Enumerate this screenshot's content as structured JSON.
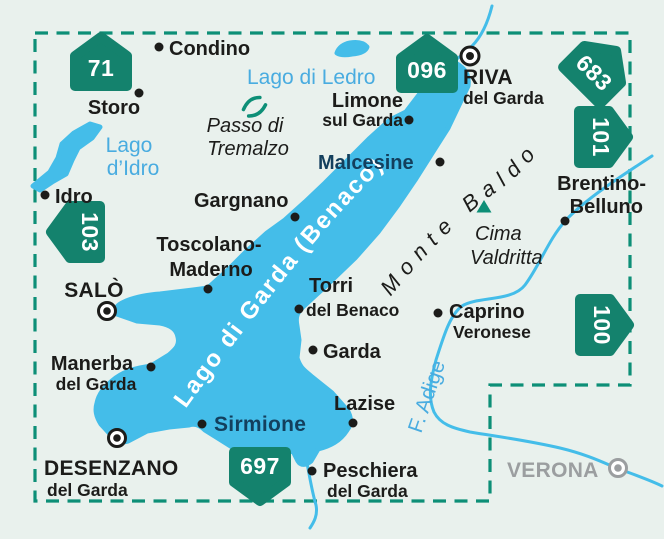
{
  "colors": {
    "background": "#e9f1ed",
    "water": "#44bde9",
    "water_label": "#49ace0",
    "badge_green": "#14826d",
    "boundary_teal": "#0d8f77",
    "town_black": "#1c1c1a",
    "lakeside_navy": "#133f5d",
    "outside_gray": "#9b9ea0",
    "label_white": "#ffffff"
  },
  "badges": {
    "b71": "71",
    "b096": "096",
    "b683": "683",
    "b101": "101",
    "b103": "103",
    "b100": "100",
    "b697": "697"
  },
  "places": {
    "condino": {
      "name": "Condino"
    },
    "storo": {
      "name": "Storo"
    },
    "idro": {
      "name": "Idro"
    },
    "riva": {
      "line1": "RIVA",
      "line2": "del Garda"
    },
    "limone": {
      "line1": "Limone",
      "line2": "sul Garda"
    },
    "malcesine": {
      "name": "Malcesine"
    },
    "gargnano": {
      "name": "Gargnano"
    },
    "toscolano": {
      "line1": "Toscolano-",
      "line2": "Maderno"
    },
    "brentino": {
      "line1": "Brentino-",
      "line2": "Belluno"
    },
    "salo": {
      "name": "SALÒ"
    },
    "manerba": {
      "line1": "Manerba",
      "line2": "del Garda"
    },
    "torri": {
      "line1": "Torri",
      "line2": "del Benaco"
    },
    "garda": {
      "name": "Garda"
    },
    "caprino": {
      "line1": "Caprino",
      "line2": "Veronese"
    },
    "sirmione": {
      "name": "Sirmione"
    },
    "lazise": {
      "name": "Lazise"
    },
    "desenzano": {
      "line1": "DESENZANO",
      "line2": "del Garda"
    },
    "peschiera": {
      "line1": "Peschiera",
      "line2": "del Garda"
    },
    "verona": {
      "name": "VERONA"
    }
  },
  "water_labels": {
    "lago_di_ledro": "Lago di Ledro",
    "lago_didro_1": "Lago",
    "lago_didro_2": "d’Idro",
    "adige": "F. Adige",
    "lake_garda": "Lago di Garda  (Benaco)"
  },
  "terrain": {
    "passo_1": "Passo di",
    "passo_2": "Tremalzo",
    "monte_baldo": "Monte Baldo",
    "cima_1": "Cima",
    "cima_2": "Valdritta"
  }
}
